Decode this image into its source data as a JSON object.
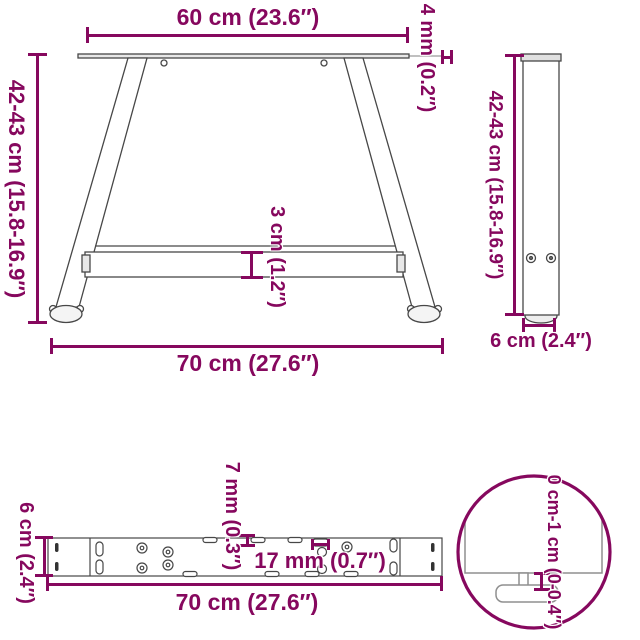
{
  "colors": {
    "accent": "#86085E",
    "line": "#474747",
    "detail_line": "#8f8f8f"
  },
  "views": {
    "front": {
      "top_width": "60 cm (23.6″)",
      "plate_thickness": "4 mm (0.2″)",
      "height": "42-43 cm (15.8-16.9″)",
      "crossbar_height": "3 cm (1.2″)",
      "bottom_width": "70 cm (27.6″)"
    },
    "side": {
      "height": "42-43 cm (15.8-16.9″)",
      "depth": "6 cm (2.4″)"
    },
    "beam": {
      "depth": "6 cm (2.4″)",
      "hole_diameter": "7 mm (0.3″)",
      "slot_length": "17 mm (0.7″)",
      "length": "70 cm (27.6″)"
    },
    "detail": {
      "adjustable_height": "0 cm-1 cm (0-0.4″)"
    }
  }
}
